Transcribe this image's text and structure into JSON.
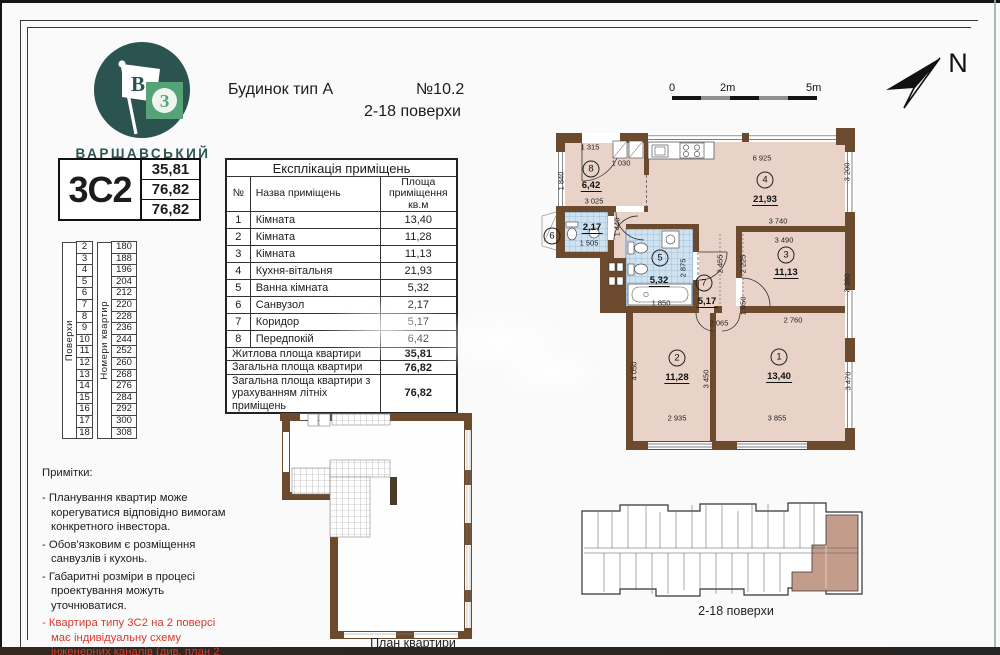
{
  "logo": {
    "brand": "ВАРШАВСЬКИЙ",
    "flag_letter": "В",
    "square_letter": "З"
  },
  "header": {
    "building": "Будинок тип А",
    "number": "№10.2",
    "floors": "2-18  поверхи"
  },
  "unit_card": {
    "type": "3С2",
    "values": [
      "35,81",
      "76,82",
      "76,82"
    ]
  },
  "floors_table": {
    "floors_caption": "Поверхи",
    "apts_caption": "Номери квартир",
    "rows": [
      {
        "floor": "2",
        "apt": "180"
      },
      {
        "floor": "3",
        "apt": "188"
      },
      {
        "floor": "4",
        "apt": "196"
      },
      {
        "floor": "5",
        "apt": "204"
      },
      {
        "floor": "6",
        "apt": "212"
      },
      {
        "floor": "7",
        "apt": "220"
      },
      {
        "floor": "8",
        "apt": "228"
      },
      {
        "floor": "9",
        "apt": "236"
      },
      {
        "floor": "10",
        "apt": "244"
      },
      {
        "floor": "11",
        "apt": "252"
      },
      {
        "floor": "12",
        "apt": "260"
      },
      {
        "floor": "13",
        "apt": "268"
      },
      {
        "floor": "14",
        "apt": "276"
      },
      {
        "floor": "15",
        "apt": "284"
      },
      {
        "floor": "16",
        "apt": "292"
      },
      {
        "floor": "17",
        "apt": "300"
      },
      {
        "floor": "18",
        "apt": "308"
      }
    ]
  },
  "explication": {
    "title": "Експлікація приміщень",
    "col_no": "№",
    "col_name": "Назва приміщень",
    "col_area": "Площа\nприміщення\nкв.м",
    "rows": [
      {
        "no": "1",
        "name": "Кімната",
        "area": "13,40"
      },
      {
        "no": "2",
        "name": "Кімната",
        "area": "11,28"
      },
      {
        "no": "3",
        "name": "Кімната",
        "area": "11,13"
      },
      {
        "no": "4",
        "name": "Кухня-вітальня",
        "area": "21,93"
      },
      {
        "no": "5",
        "name": "Ванна кімната",
        "area": "5,32"
      },
      {
        "no": "6",
        "name": "Санвузол",
        "area": "2,17"
      },
      {
        "no": "7",
        "name": "Коридор",
        "area": "5,17"
      },
      {
        "no": "8",
        "name": "Передпокій",
        "area": "6,42"
      }
    ],
    "summary": [
      {
        "label": "Житлова площа квартири",
        "value": "35,81"
      },
      {
        "label": "Загальна площа квартири",
        "value": "76,82"
      },
      {
        "label": "Загальна площа квартири з урахуванням літніх приміщень",
        "value": "76,82"
      }
    ]
  },
  "notes": {
    "title": "Примітки:",
    "items": [
      "Планування квартир може корегуватися відповідно вимогам конкретного інвестора.",
      "Обов'язковим є розміщення санвузлів і кухонь.",
      "Габаритні розміри в процесі проектування можуть уточнюватися."
    ],
    "warning": "Квартира типу 3С2 на 2 поверсі має індивідуальну схему інженерних каналів (див. план 2 поверху)."
  },
  "scalebar": {
    "t0": "0",
    "t2": "2m",
    "t5": "5m"
  },
  "compass": {
    "label": "N"
  },
  "floorplan": {
    "labels": [
      {
        "t": "1 315",
        "x": 590,
        "y": 147,
        "kind": "dim"
      },
      {
        "t": "1 030",
        "x": 621,
        "y": 163,
        "kind": "dim"
      },
      {
        "t": "1 840",
        "x": 561,
        "y": 181,
        "kind": "dim",
        "rot": 1
      },
      {
        "t": "3 025",
        "x": 594,
        "y": 201,
        "kind": "dim"
      },
      {
        "t": "6 925",
        "x": 762,
        "y": 158,
        "kind": "dim"
      },
      {
        "t": "3 200",
        "x": 847,
        "y": 172,
        "kind": "dim",
        "rot": 1
      },
      {
        "t": "1 505",
        "x": 589,
        "y": 243,
        "kind": "dim"
      },
      {
        "t": "1 440",
        "x": 617,
        "y": 227,
        "kind": "dim",
        "rot": 1
      },
      {
        "t": "2 875",
        "x": 683,
        "y": 268,
        "kind": "dim",
        "rot": 1
      },
      {
        "t": "1 850",
        "x": 661,
        "y": 303,
        "kind": "dim"
      },
      {
        "t": "3 740",
        "x": 778,
        "y": 221,
        "kind": "dim"
      },
      {
        "t": "3 490",
        "x": 784,
        "y": 240,
        "kind": "dim"
      },
      {
        "t": "2 455",
        "x": 720,
        "y": 264,
        "kind": "dim",
        "rot": 1
      },
      {
        "t": "2 225",
        "x": 743,
        "y": 264,
        "kind": "dim",
        "rot": 1
      },
      {
        "t": "3 390",
        "x": 847,
        "y": 283,
        "kind": "dim",
        "rot": 1
      },
      {
        "t": "2 065",
        "x": 719,
        "y": 323,
        "kind": "dim"
      },
      {
        "t": "1 050",
        "x": 743,
        "y": 306,
        "kind": "dim",
        "rot": 1
      },
      {
        "t": "2 760",
        "x": 793,
        "y": 320,
        "kind": "dim"
      },
      {
        "t": "4 050",
        "x": 634,
        "y": 371,
        "kind": "dim",
        "rot": 1
      },
      {
        "t": "3 450",
        "x": 706,
        "y": 379,
        "kind": "dim",
        "rot": 1
      },
      {
        "t": "3 470",
        "x": 848,
        "y": 381,
        "kind": "dim",
        "rot": 1
      },
      {
        "t": "2 935",
        "x": 677,
        "y": 418,
        "kind": "dim"
      },
      {
        "t": "3 855",
        "x": 777,
        "y": 418,
        "kind": "dim"
      },
      {
        "t": "6,42",
        "x": 591,
        "y": 186,
        "kind": "area"
      },
      {
        "t": "21,93",
        "x": 765,
        "y": 200,
        "kind": "area"
      },
      {
        "t": "2,17",
        "x": 592,
        "y": 228,
        "kind": "area"
      },
      {
        "t": "5,32",
        "x": 659,
        "y": 281,
        "kind": "area"
      },
      {
        "t": "5,17",
        "x": 707,
        "y": 302,
        "kind": "area"
      },
      {
        "t": "11,13",
        "x": 786,
        "y": 273,
        "kind": "area"
      },
      {
        "t": "11,28",
        "x": 677,
        "y": 378,
        "kind": "area"
      },
      {
        "t": "13,40",
        "x": 779,
        "y": 377,
        "kind": "area"
      },
      {
        "t": "8",
        "x": 591,
        "y": 169,
        "kind": "room"
      },
      {
        "t": "4",
        "x": 765,
        "y": 180,
        "kind": "room"
      },
      {
        "t": "6",
        "x": 552,
        "y": 236,
        "kind": "room"
      },
      {
        "t": "5",
        "x": 660,
        "y": 258,
        "kind": "room"
      },
      {
        "t": "7",
        "x": 704,
        "y": 283,
        "kind": "room"
      },
      {
        "t": "3",
        "x": 786,
        "y": 255,
        "kind": "room"
      },
      {
        "t": "2",
        "x": 677,
        "y": 358,
        "kind": "room"
      },
      {
        "t": "1",
        "x": 779,
        "y": 357,
        "kind": "room"
      }
    ]
  },
  "keyplan": {
    "caption": "2-18 поверхи"
  },
  "structural": {
    "caption": "План квартири"
  },
  "colors": {
    "wall": "#6b4a2e",
    "room_fill": "#e9d2c8",
    "tile": "#cfe2f0",
    "highlight": "#c49c8c",
    "brand": "#2b5450",
    "brand_green": "#57a378",
    "warning_red": "#d63a2e"
  }
}
